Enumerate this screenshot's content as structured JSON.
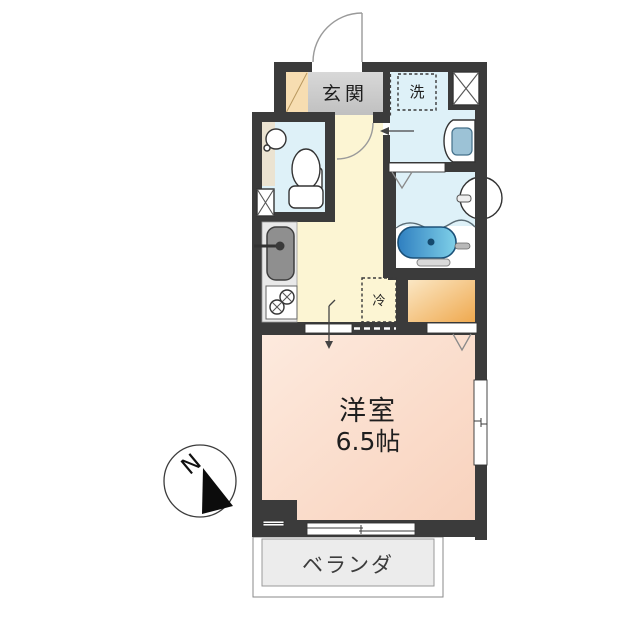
{
  "plan": {
    "type": "apartment-floor-plan",
    "labels": {
      "entrance": "玄関",
      "laundry": "洗",
      "refrigerator": "冷",
      "main_room_name": "洋室",
      "main_room_size": "6.5帖",
      "balcony": "ベランダ",
      "compass_north": "N"
    },
    "colors": {
      "wall": "#3b3b3b",
      "wet_floor": "#def1f8",
      "kitchen_floor": "#fcf5d3",
      "genkan_floor": "#cbcbcb",
      "shoe_cabinet": "#f7ddb1",
      "toilet_counter": "#ebe3d1",
      "main_room_floor": "#fbdccb",
      "closet": "#f2b765",
      "balcony_floor": "#ececec",
      "bathtub": "#3c8ec9",
      "counter": "#e9e9e9",
      "sink": "#8f8f8f",
      "basin_bowl": "#9cc2d6"
    }
  }
}
